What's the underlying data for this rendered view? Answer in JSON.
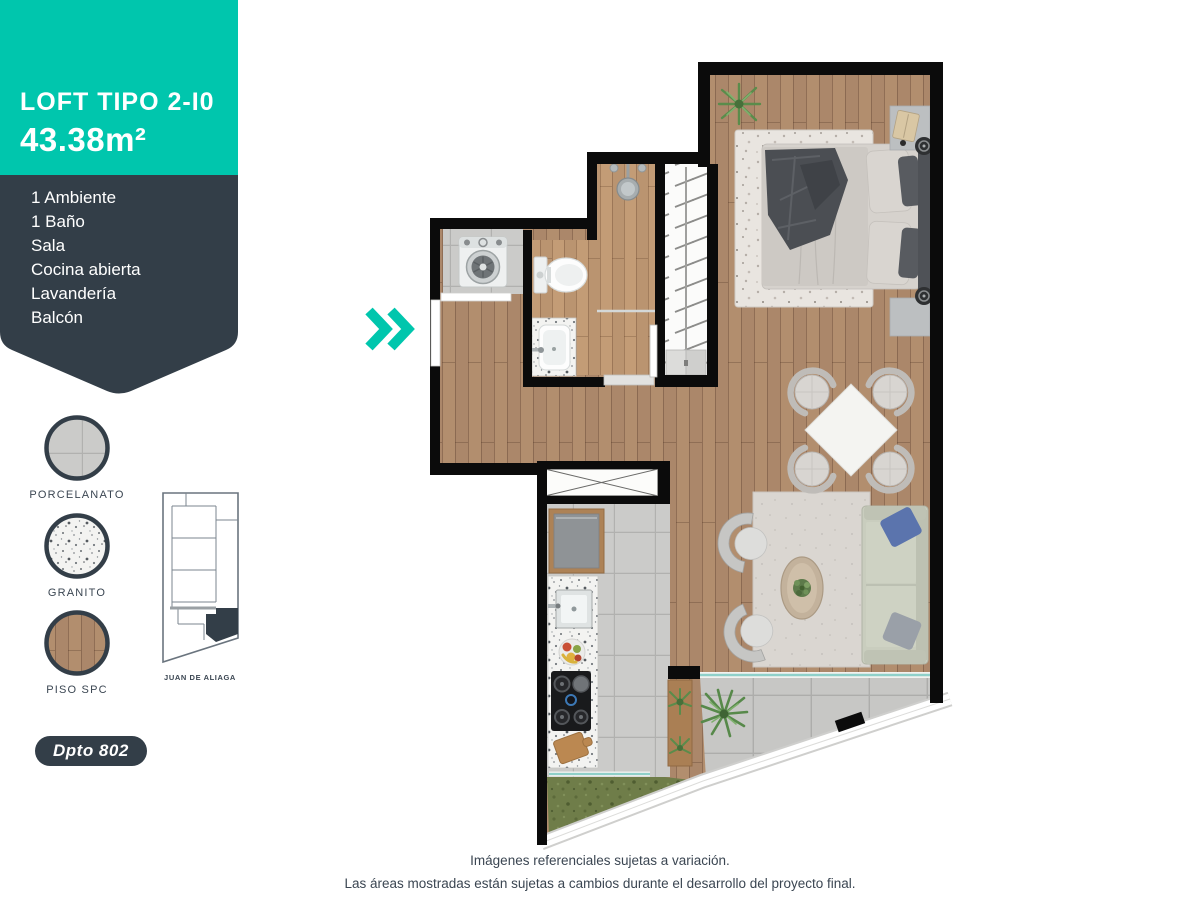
{
  "header": {
    "title": "LOFT TIPO 2-I0",
    "area": "43.38m²"
  },
  "features": [
    "1 Ambiente",
    "1 Baño",
    "Sala",
    "Cocina abierta",
    "Lavandería",
    "Balcón"
  ],
  "materials": [
    {
      "label": "PORCELANATO"
    },
    {
      "label": "GRANITO"
    },
    {
      "label": "PISO SPC"
    }
  ],
  "keyplan": {
    "label": "JUAN DE ALIAGA"
  },
  "unit_badge": {
    "label": "Dpto 802"
  },
  "icons": {
    "chevron": "double-chevron-right-icon"
  },
  "disclaimer": {
    "line1": "Imágenes referenciales sujetas a variación.",
    "line2": "Las áreas mostradas están sujetas a cambios durante el desarrollo del proyecto final."
  },
  "colors": {
    "teal": "#00c6ad",
    "dark": "#333e48",
    "text": "#3b4652",
    "wall": "#0b0b0b"
  }
}
